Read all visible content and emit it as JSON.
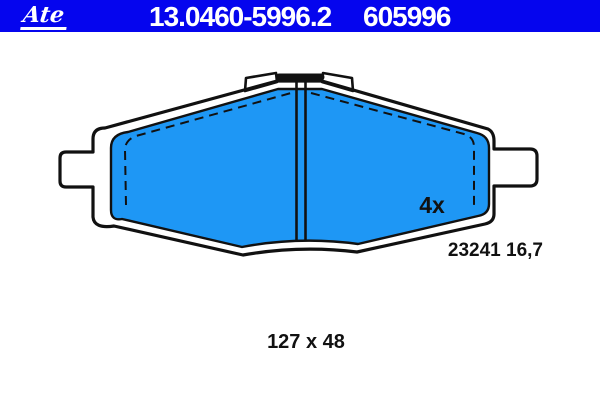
{
  "header": {
    "logo_text": "Ate",
    "part_number": "13.0460-5996.2",
    "reference_number": "605996"
  },
  "drawing": {
    "quantity": "4x",
    "wva_thickness": "23241 16,7",
    "dimensions": "127 x 48"
  },
  "colors": {
    "banner_blue": "#0505ee",
    "pad_blue": "#1e97f5",
    "line_black": "#111111",
    "text_white": "#ffffff",
    "background": "#ffffff"
  }
}
